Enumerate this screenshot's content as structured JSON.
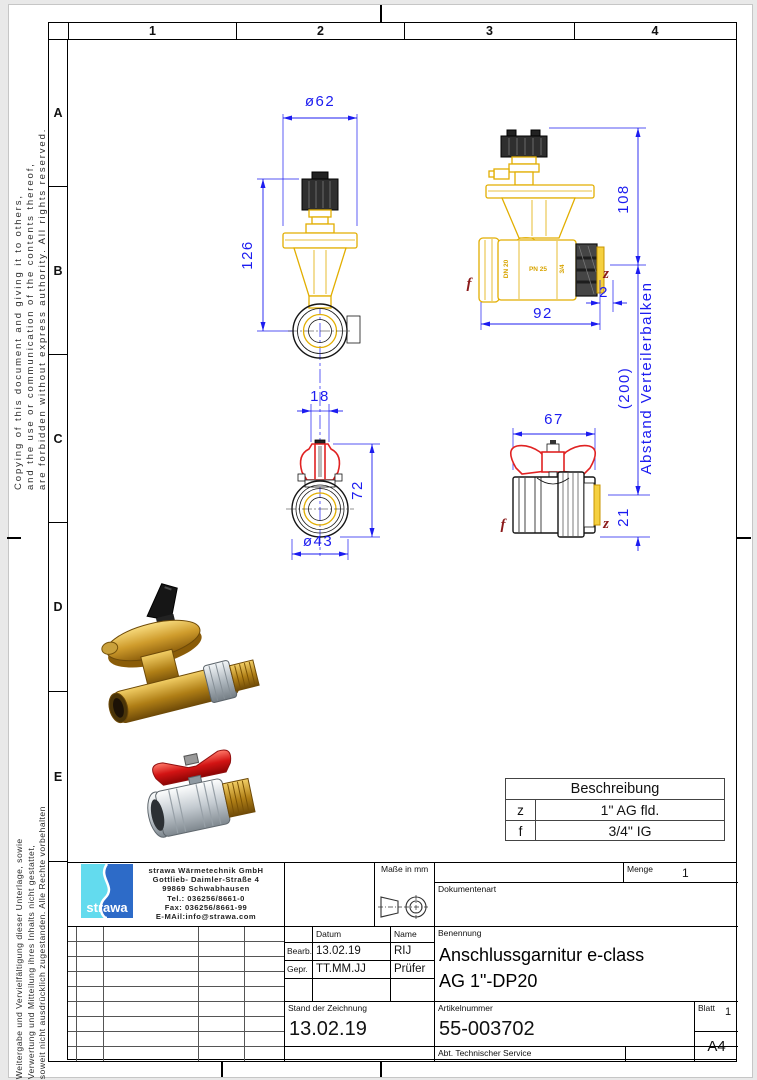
{
  "frame": {
    "columns": [
      "1",
      "2",
      "3",
      "4"
    ],
    "rows": [
      "A",
      "B",
      "C",
      "D",
      "E"
    ]
  },
  "margin_notes": {
    "english": [
      "Copying of this document and giving it to others,",
      "and the use or communication of the contents thereof,",
      "are forbidden without express authority. All rights reserved."
    ],
    "german": [
      "Weitergabe und Vervielfältigung dieser Unterlage, sowie",
      "Verwertung und Mitteilung ihres Inhalts nicht gestattet,",
      "soweit nicht ausdrücklich zugestanden. Alle Rechte vorbehalten"
    ]
  },
  "drawing": {
    "colors": {
      "dimension_blue": "#1c1cf0",
      "outline_yellow": "#e2ae00",
      "handle_red": "#e02222",
      "port_label_red": "#8b1a1a"
    },
    "front_view": {
      "width": "ø62",
      "height": "126"
    },
    "side_view": {
      "height": "108",
      "length": "92",
      "washer": "2"
    },
    "ball_front": {
      "neck": "18",
      "height": "72",
      "diameter": "ø43"
    },
    "ball_side": {
      "length": "67",
      "offset": "21"
    },
    "spacing_note": {
      "value": "(200)",
      "label": "Abstand Verteilerbalken"
    },
    "ports": {
      "f": "f",
      "z": "z"
    },
    "marks": {
      "dr": "DR",
      "dn": "DN 20",
      "pn": "PN 25",
      "size": "3/4"
    }
  },
  "legend": {
    "title": "Beschreibung",
    "rows": [
      {
        "key": "z",
        "value": "1\" AG fld."
      },
      {
        "key": "f",
        "value": "3/4\" IG"
      }
    ]
  },
  "title_block": {
    "company": {
      "logo_text": "strawa",
      "name": "strawa Wärmetechnik GmbH",
      "street": "Gottlieb- Daimler-Straße 4",
      "city": "99869 Schwabhausen",
      "tel": "Tel.: 036256/8661-0",
      "fax": "Fax: 036256/8661-99",
      "email": "E-MAil:info@strawa.com"
    },
    "units_label": "Maße in mm",
    "menge_label": "Menge",
    "menge_value": "1",
    "dokumentenart_label": "Dokumentenart",
    "benennung_label": "Benennung",
    "benennung_line1": "Anschlussgarnitur e-class",
    "benennung_line2": "AG 1\"-DP20",
    "datum_label": "Datum",
    "name_label": "Name",
    "bearb_label": "Bearb.",
    "bearb_datum": "13.02.19",
    "bearb_name": "RIJ",
    "gepr_label": "Gepr.",
    "gepr_datum": "TT.MM.JJ",
    "gepr_name": "Prüfer",
    "stand_label": "Stand der Zeichnung",
    "stand_value": "13.02.19",
    "artikel_label": "Artikelnummer",
    "artikel_value": "55-003702",
    "blatt_label": "Blatt",
    "blatt_value": "1",
    "format": "A4",
    "abt": "Abt. Technischer Service"
  }
}
